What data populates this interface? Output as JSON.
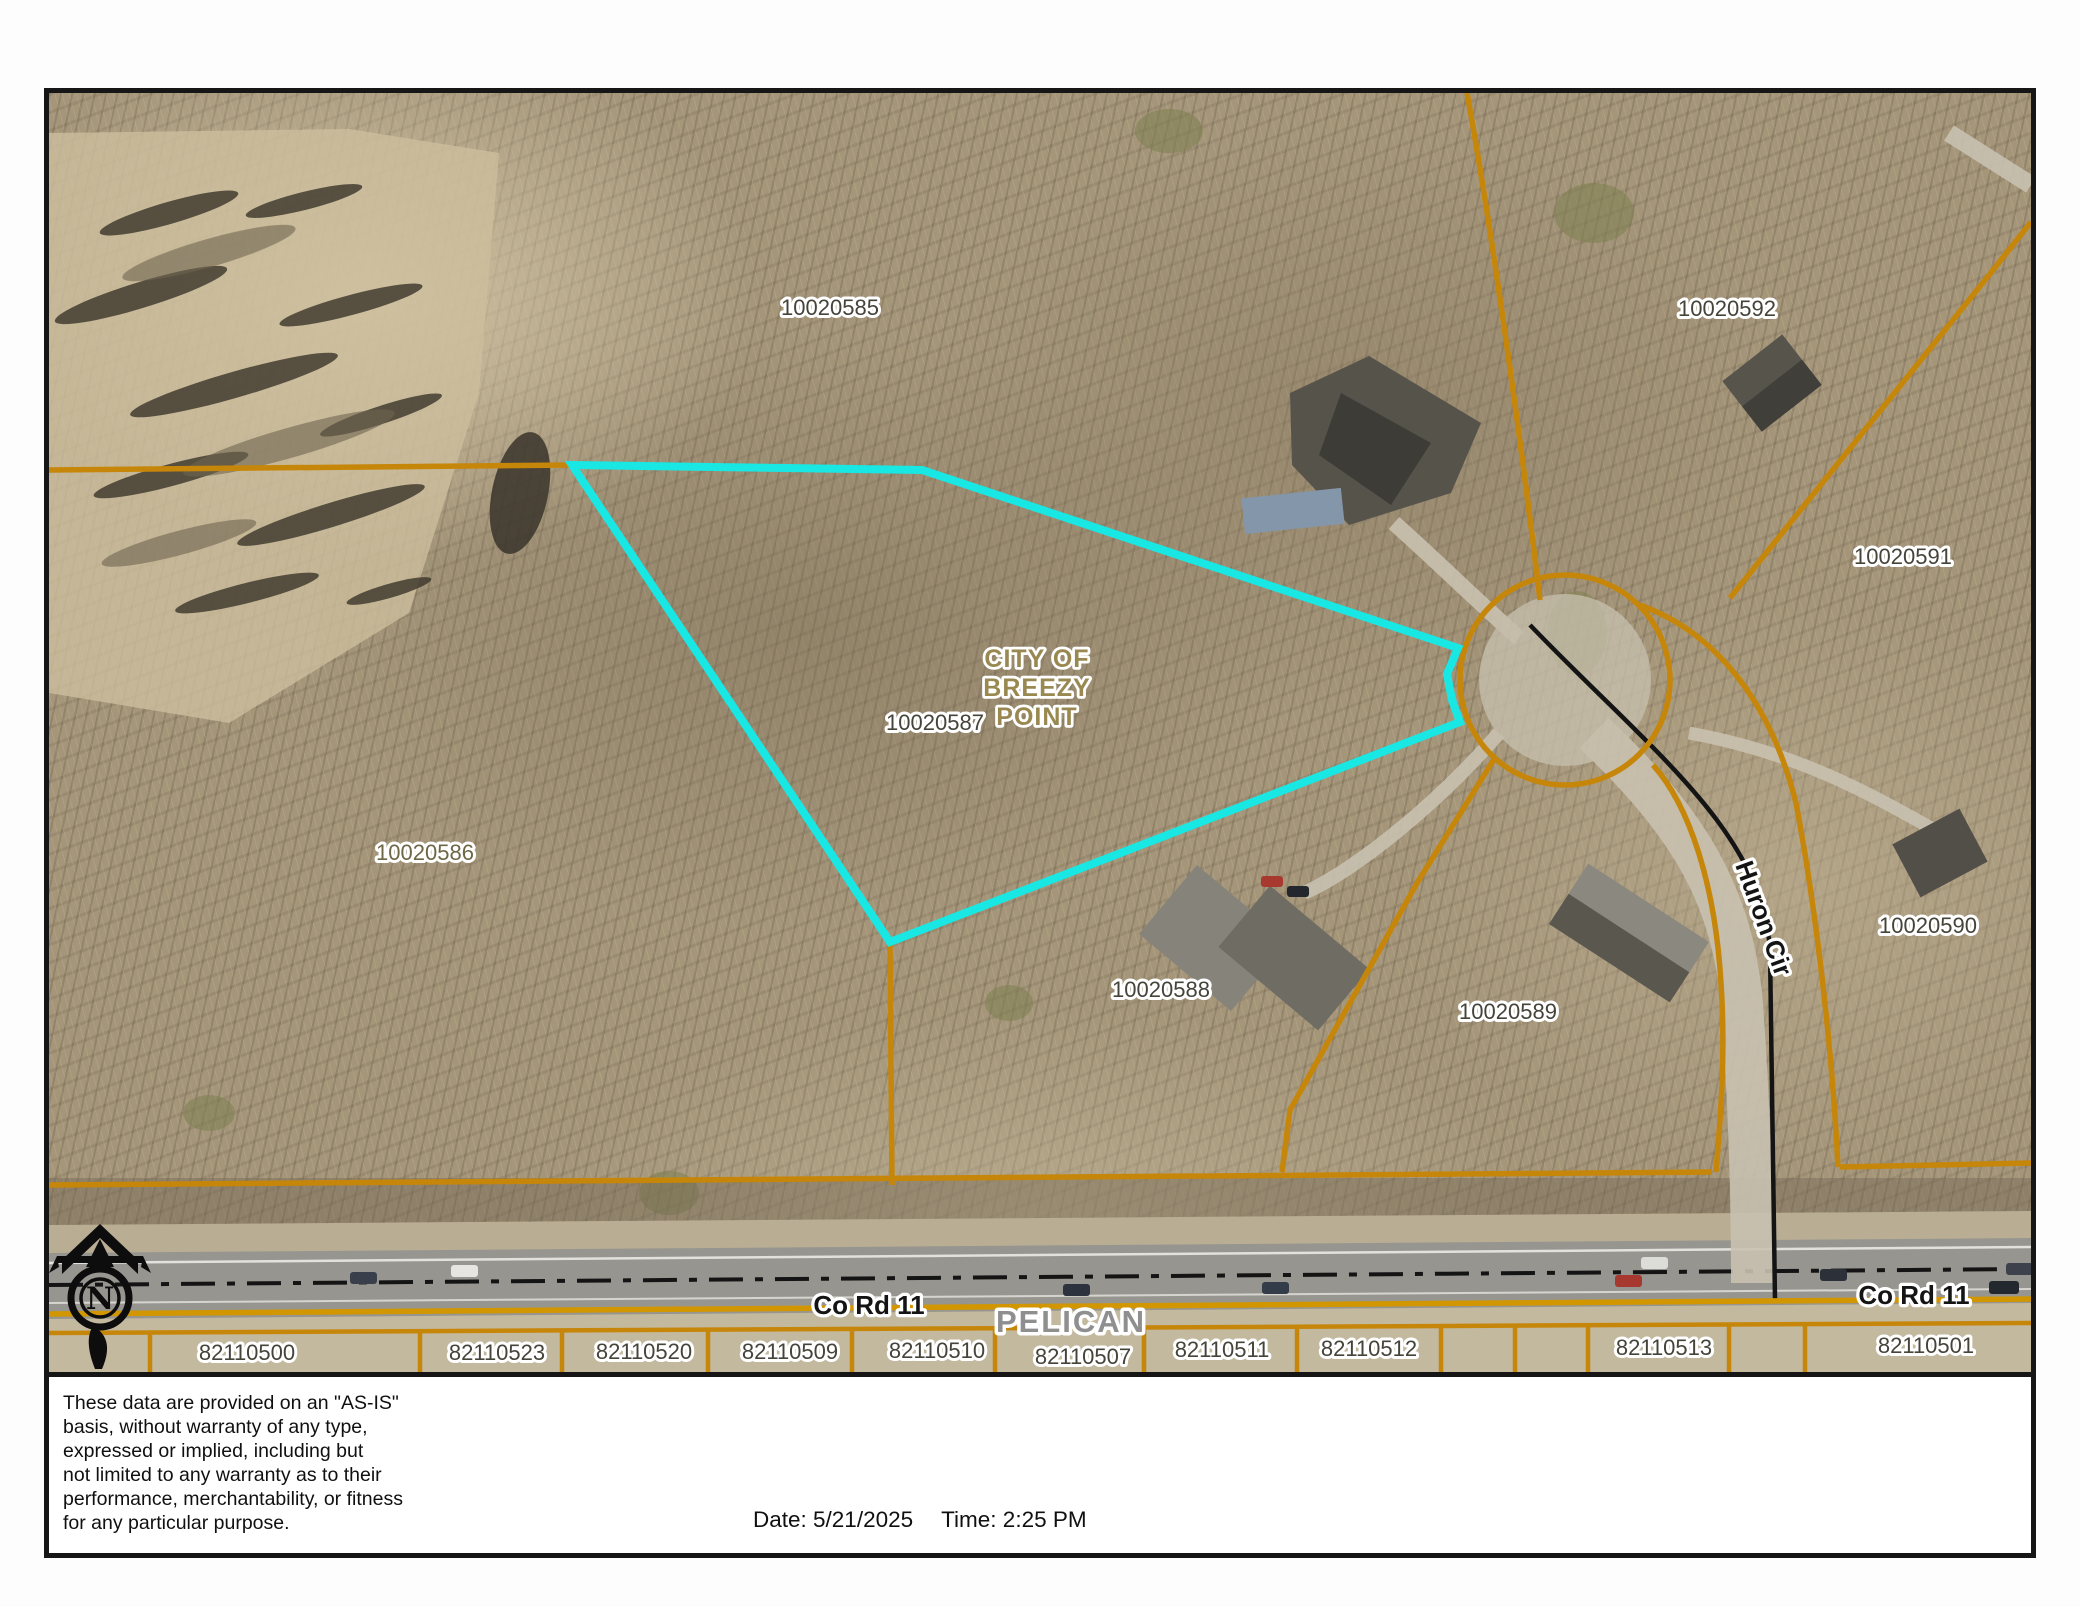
{
  "map": {
    "parcel_labels": {
      "p10020585": "10020585",
      "p10020586": "10020586",
      "p10020587": "10020587",
      "p10020588": "10020588",
      "p10020589": "10020589",
      "p10020590": "10020590",
      "p10020591": "10020591",
      "p10020592": "10020592"
    },
    "city_overlay": {
      "line1": "CITY OF",
      "line2": "BREEZY",
      "line3": "POINT"
    },
    "roads": {
      "co_rd_11": "Co Rd 11",
      "huron_cir": "Huron Cir"
    },
    "township": "PELICAN",
    "north_letter": "N",
    "bottom_parcels": [
      "82110500",
      "82110523",
      "82110520",
      "82110509",
      "82110510",
      "82110507",
      "82110511",
      "82110512",
      "82110513",
      "82110501"
    ],
    "colors": {
      "parcel_line": "#c6860a",
      "highlight": "#19e7e3",
      "road_paint": "#d29700",
      "road_centerline": "#141414"
    }
  },
  "footer": {
    "disclaimer": "These data are provided on an \"AS-IS\"\nbasis, without warranty of any type,\nexpressed or implied, including but\nnot limited to any warranty as to their\nperformance, merchantability, or fitness\nfor any particular purpose.",
    "date_text": "Date: 5/21/2025",
    "time_text": "Time: 2:25 PM"
  }
}
